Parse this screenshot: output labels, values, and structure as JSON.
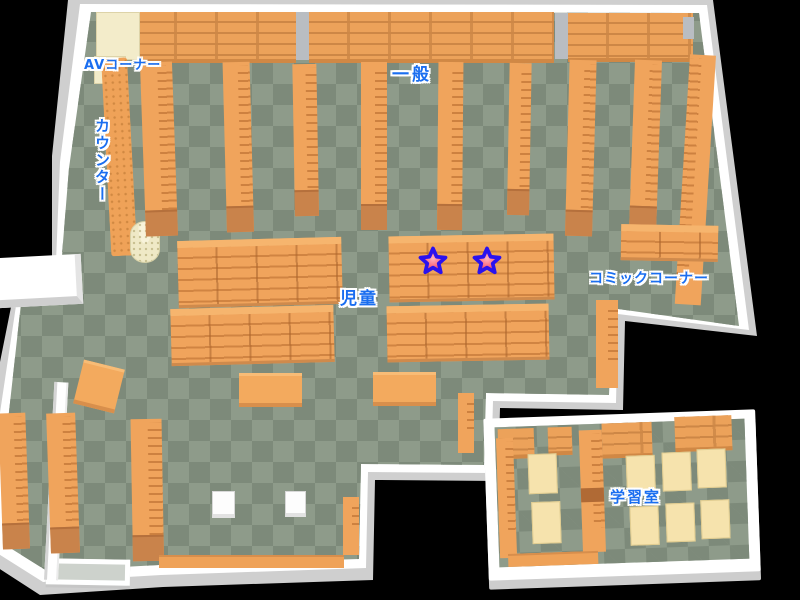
{
  "map": {
    "title": "library-floor-map",
    "labels": {
      "av_corner": "AVコーナー",
      "general": "一般",
      "counter": "カウンター",
      "children": "児童",
      "comic_corner": "コミックコーナー",
      "study_room": "学習室"
    },
    "markers": [
      {
        "id": 1,
        "symbol": "star",
        "area": "children"
      },
      {
        "id": 2,
        "symbol": "star",
        "area": "children"
      }
    ],
    "colors": {
      "floor_light": "#8e9b8a",
      "floor_dark": "#7d8a7a",
      "shelf_orange": "#f0a45c",
      "shelf_dark": "#c9834a",
      "wall_white": "#ffffff",
      "wall_shade": "#cfcfcf",
      "desk_cream": "#f3ecca",
      "study_desk_cream": "#f6e3ad",
      "label_blue": "#1a6ef0",
      "star_fill": "#f83b55",
      "star_outline": "#2a12ee"
    }
  }
}
